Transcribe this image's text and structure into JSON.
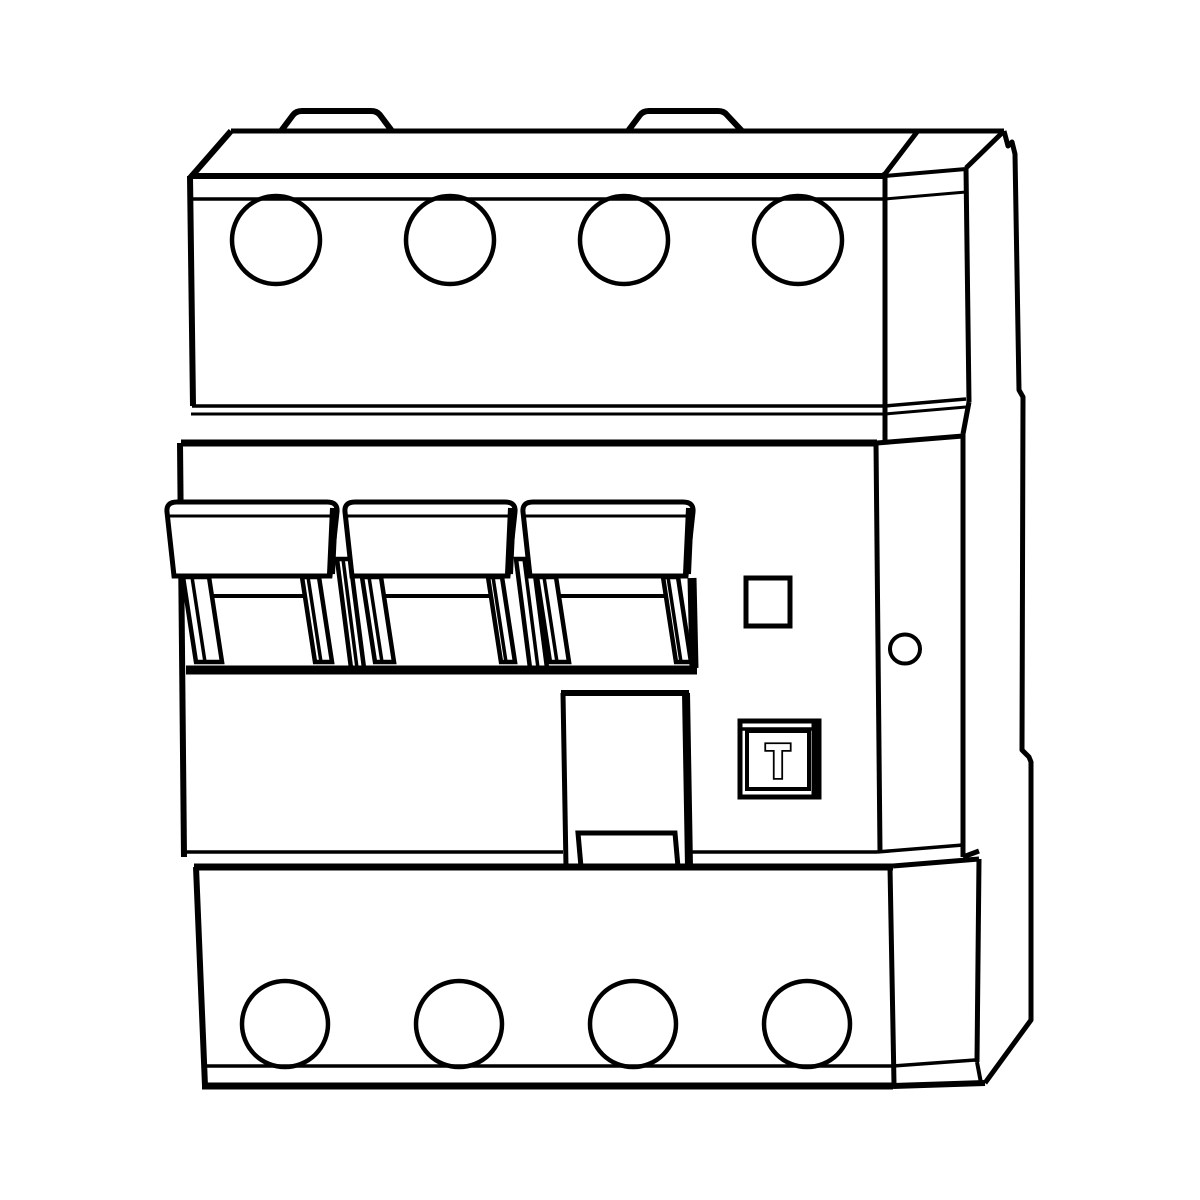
{
  "figure": {
    "caption": "Line drawing of a four-pole residual current circuit breaker",
    "background_color": "#ffffff",
    "line_color": "#000000",
    "test_button_label": "T",
    "top_terminal_count": 4,
    "bottom_terminal_count": 4,
    "toggle_handle_count": 3
  }
}
